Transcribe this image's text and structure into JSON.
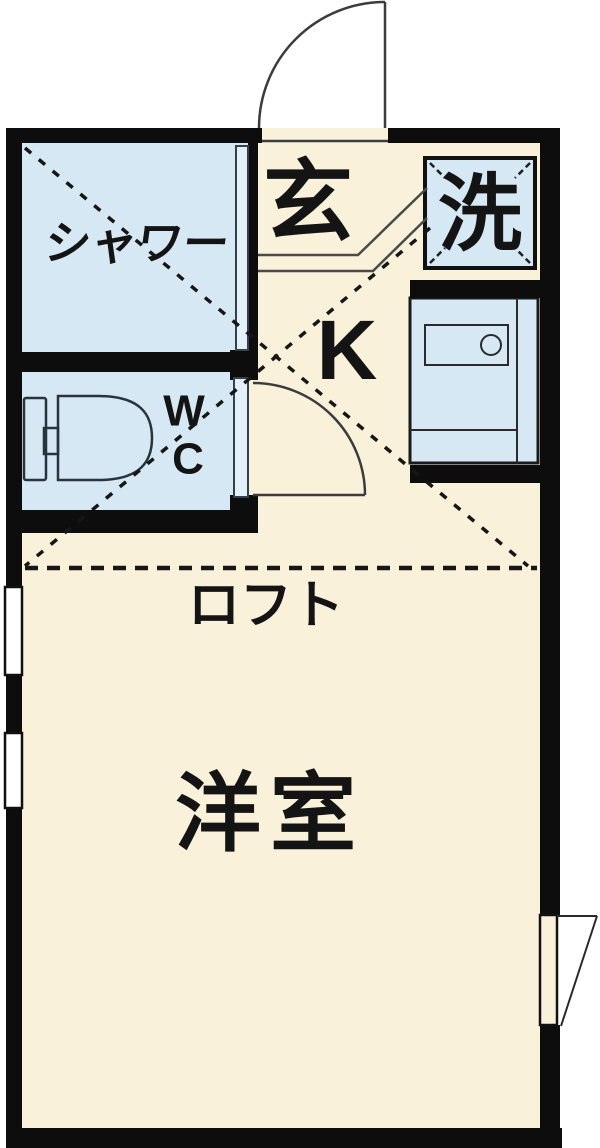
{
  "floorplan": {
    "labels": {
      "shower": "シャワー",
      "entrance": "玄",
      "laundry": "洗",
      "kitchen": "K",
      "toilet_line1": "W",
      "toilet_line2": "C",
      "loft": "ロフト",
      "western_room": "洋室"
    },
    "colors": {
      "background": "#ffffff",
      "floor": "#f9f1da",
      "wet_area": "#d5e8f4",
      "wall": "#0d0d0d",
      "text": "#141414"
    }
  }
}
